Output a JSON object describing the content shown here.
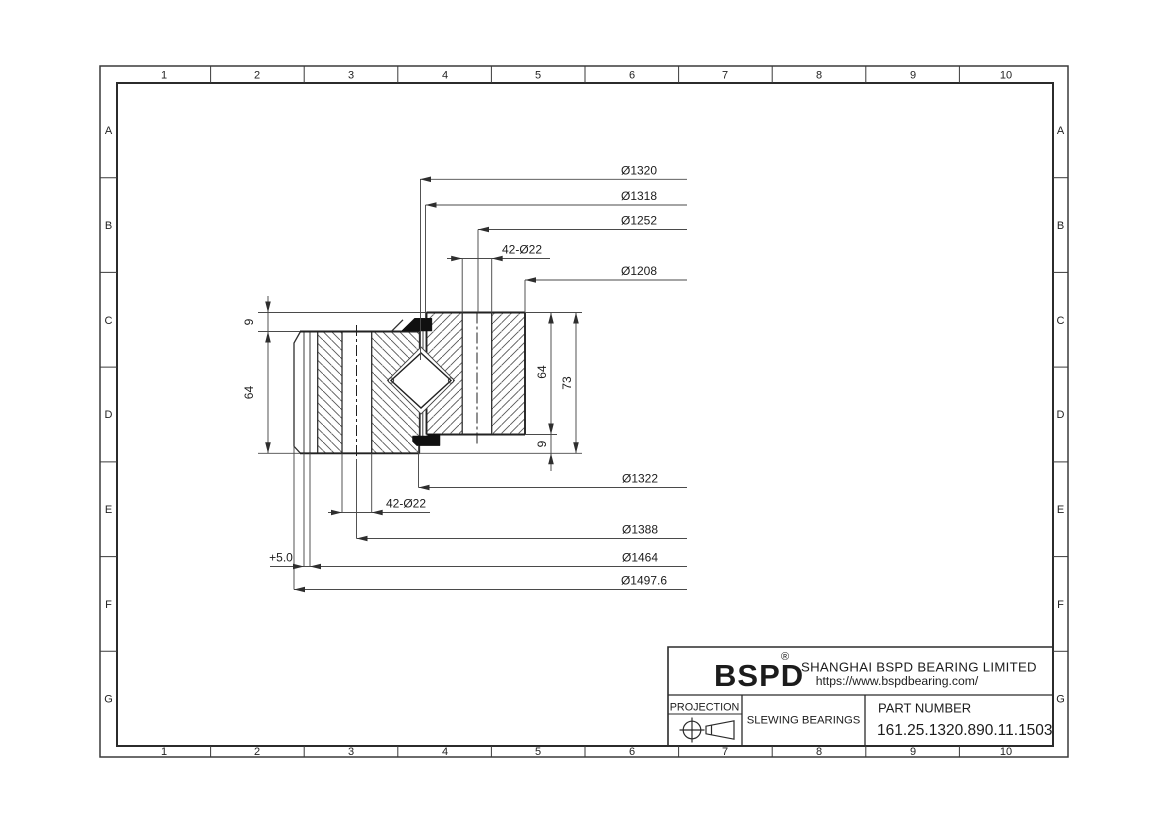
{
  "colors": {
    "background": "#ffffff",
    "line": "#2b2b2b",
    "seal_fill": "#101010"
  },
  "grid": {
    "cols": [
      "1",
      "2",
      "3",
      "4",
      "5",
      "6",
      "7",
      "8",
      "9",
      "10"
    ],
    "rows": [
      "A",
      "B",
      "C",
      "D",
      "E",
      "F",
      "G"
    ]
  },
  "dimensions": {
    "top": [
      "Ø1320",
      "Ø1318",
      "Ø1252",
      "42-Ø22",
      "Ø1208"
    ],
    "bottom": [
      "Ø1322",
      "42-Ø22",
      "Ø1388",
      "Ø1464",
      "Ø1497.6"
    ],
    "offset": "+5.0",
    "left": [
      "9",
      "64"
    ],
    "right": [
      "64",
      "73",
      "9"
    ]
  },
  "title_block": {
    "logo": "BSPD",
    "registered_mark": "®",
    "company": "SHANGHAI BSPD BEARING LIMITED",
    "website": "https://www.bspdbearing.com/",
    "projection_label": "PROJECTION",
    "product_type": "SLEWING BEARINGS",
    "part_number_label": "PART  NUMBER",
    "part_number": "161.25.1320.890.11.1503"
  }
}
